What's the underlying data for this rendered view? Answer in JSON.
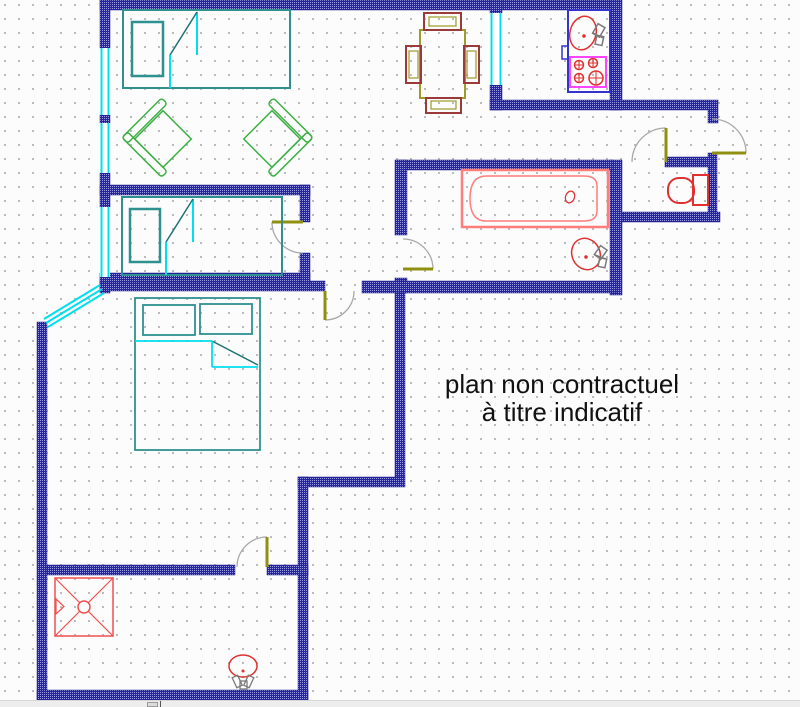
{
  "annotation": {
    "line1": "plan non contractuel",
    "line2": "à titre indicatif",
    "x_center": 562,
    "y_top": 370,
    "font_size": 26,
    "color": "#111111"
  },
  "canvas": {
    "width": 800,
    "height": 700,
    "bg": "#fcfcfc",
    "grid_dot_color": "#bcbcbc",
    "grid_step": 14
  },
  "strip": {
    "y": 700,
    "height": 7,
    "bg": "#ededed",
    "border": "#d6d6d6",
    "handle": {
      "x": 147,
      "y": 701,
      "w": 11,
      "h": 5,
      "fill": "#dcdcdc",
      "border": "#9a9a9a"
    },
    "caret": {
      "x": 160,
      "color": "#555555"
    }
  },
  "plan": {
    "wall_base": "#26269c",
    "wall_fleck": "#9b9be0",
    "wall_edge": "#1e1e8e",
    "window_color": "#00dfee",
    "door_leaf_color": "#8f8f12",
    "door_arc_color": "#a8a8a8",
    "walls": [
      [
        100,
        0,
        520,
        10
      ],
      [
        100,
        0,
        10,
        48
      ],
      [
        100,
        115,
        10,
        8
      ],
      [
        100,
        173,
        10,
        34
      ],
      [
        100,
        277,
        10,
        16
      ],
      [
        490,
        0,
        12,
        13
      ],
      [
        490,
        85,
        12,
        25
      ],
      [
        610,
        0,
        12,
        110
      ],
      [
        490,
        100,
        228,
        10
      ],
      [
        708,
        110,
        10,
        13
      ],
      [
        708,
        153,
        9,
        62
      ],
      [
        665,
        157,
        47,
        10
      ],
      [
        615,
        212,
        105,
        10
      ],
      [
        610,
        160,
        12,
        135
      ],
      [
        398,
        160,
        215,
        10
      ],
      [
        395,
        160,
        12,
        75
      ],
      [
        395,
        278,
        12,
        15
      ],
      [
        362,
        281,
        255,
        12
      ],
      [
        100,
        281,
        225,
        10
      ],
      [
        100,
        273,
        210,
        10
      ],
      [
        100,
        185,
        210,
        10
      ],
      [
        300,
        185,
        10,
        37
      ],
      [
        300,
        253,
        10,
        30
      ],
      [
        395,
        293,
        10,
        184
      ],
      [
        298,
        477,
        107,
        10
      ],
      [
        298,
        477,
        10,
        223
      ],
      [
        37,
        322,
        10,
        378
      ],
      [
        37,
        690,
        271,
        10
      ],
      [
        47,
        565,
        188,
        10
      ],
      [
        267,
        565,
        41,
        10
      ]
    ],
    "windows": [
      {
        "x": 100,
        "y": 48,
        "w": 10,
        "h": 67
      },
      {
        "x": 100,
        "y": 123,
        "w": 10,
        "h": 50
      },
      {
        "x": 100,
        "y": 207,
        "w": 10,
        "h": 70
      },
      {
        "x": 490,
        "y": 13,
        "w": 12,
        "h": 72
      }
    ],
    "diagonal_window": [
      [
        100,
        285,
        44,
        319
      ],
      [
        102,
        289,
        46,
        323
      ],
      [
        104,
        293,
        48,
        327
      ]
    ],
    "doors": [
      {
        "name": "entrance-door",
        "leaf": [
          712,
          153,
          746,
          153
        ],
        "arc": "M 746,153 A 34 34 0 0 0 712,119"
      },
      {
        "name": "wc-door",
        "leaf": [
          666,
          128,
          666,
          162
        ],
        "arc": "M 666,128 A 34 34 0 0 0 632,162"
      },
      {
        "name": "bathroom-door",
        "leaf": [
          403,
          269,
          433,
          269
        ],
        "arc": "M 433,269 A 30 30 0 0 0 403,239"
      },
      {
        "name": "middle-bedroom-door",
        "leaf": [
          303,
          222,
          272,
          222
        ],
        "arc": "M 272,222 A 31 31 0 0 0 303,253"
      },
      {
        "name": "master-bedroom-door",
        "leaf": [
          325,
          291,
          325,
          320
        ],
        "arc": "M 325,320 A 29 29 0 0 0 354,291"
      },
      {
        "name": "shower-room-door",
        "leaf": [
          267,
          537,
          267,
          567
        ],
        "arc": "M 267,537 A 30 30 0 0 0 237,567"
      }
    ],
    "objects": [
      {
        "name": "single-bed-top",
        "items": [
          {
            "t": "rect",
            "x": 123,
            "y": 10,
            "w": 167,
            "h": 78,
            "st": "#2f9090",
            "sw": 2
          },
          {
            "t": "rect",
            "x": 132,
            "y": 22,
            "w": 31,
            "h": 54,
            "st": "#2f9090",
            "sw": 2.5
          },
          {
            "t": "line",
            "x1": 197,
            "y1": 12,
            "x2": 197,
            "y2": 55,
            "st": "#00dfee",
            "sw": 2
          },
          {
            "t": "line",
            "x1": 197,
            "y1": 12,
            "x2": 170,
            "y2": 55,
            "st": "#1d7272",
            "sw": 1.5
          },
          {
            "t": "line",
            "x1": 170,
            "y1": 55,
            "x2": 170,
            "y2": 88,
            "st": "#00dfee",
            "sw": 2
          }
        ]
      },
      {
        "name": "single-bed-middle",
        "items": [
          {
            "t": "rect",
            "x": 122,
            "y": 197,
            "w": 160,
            "h": 78,
            "st": "#2f9090",
            "sw": 2
          },
          {
            "t": "rect",
            "x": 130,
            "y": 209,
            "w": 30,
            "h": 53,
            "st": "#2f9090",
            "sw": 2.5
          },
          {
            "t": "line",
            "x1": 193,
            "y1": 199,
            "x2": 193,
            "y2": 242,
            "st": "#00dfee",
            "sw": 2
          },
          {
            "t": "line",
            "x1": 193,
            "y1": 199,
            "x2": 166,
            "y2": 242,
            "st": "#1d7272",
            "sw": 1.5
          },
          {
            "t": "line",
            "x1": 166,
            "y1": 242,
            "x2": 166,
            "y2": 275,
            "st": "#00dfee",
            "sw": 2
          }
        ]
      },
      {
        "name": "armchair-left",
        "items": [
          {
            "t": "rect",
            "x": 143,
            "y": 119,
            "w": 40,
            "h": 40,
            "st": "#3cb044",
            "sw": 1.5,
            "tr": "rotate(45 163 139)"
          },
          {
            "t": "rect",
            "x": 133,
            "y": 111,
            "w": 8,
            "h": 56,
            "rx": 3,
            "st": "#3cb044",
            "sw": 1.5,
            "tr": "rotate(45 163 139)"
          },
          {
            "t": "rect",
            "x": 133,
            "y": 159,
            "w": 56,
            "h": 8,
            "rx": 3,
            "st": "#3cb044",
            "sw": 1.5,
            "tr": "rotate(45 163 139)"
          }
        ]
      },
      {
        "name": "armchair-right",
        "items": [
          {
            "t": "rect",
            "x": 252,
            "y": 119,
            "w": 40,
            "h": 40,
            "st": "#3cb044",
            "sw": 1.5,
            "tr": "rotate(-45 272 139)"
          },
          {
            "t": "rect",
            "x": 294,
            "y": 111,
            "w": 8,
            "h": 56,
            "rx": 3,
            "st": "#3cb044",
            "sw": 1.5,
            "tr": "rotate(-45 272 139)"
          },
          {
            "t": "rect",
            "x": 246,
            "y": 159,
            "w": 56,
            "h": 8,
            "rx": 3,
            "st": "#3cb044",
            "sw": 1.5,
            "tr": "rotate(-45 272 139)"
          }
        ]
      },
      {
        "name": "dining-table",
        "items": [
          {
            "t": "rect",
            "x": 420,
            "y": 30,
            "w": 45,
            "h": 68,
            "st": "#9c9c2a",
            "sw": 2
          },
          {
            "t": "rect",
            "x": 424,
            "y": 13,
            "w": 37,
            "h": 17,
            "st": "#9c3a3a",
            "sw": 2
          },
          {
            "t": "rect",
            "x": 429,
            "y": 17,
            "w": 27,
            "h": 9,
            "st": "#9c9c2a",
            "sw": 1.2
          },
          {
            "t": "rect",
            "x": 426,
            "y": 98,
            "w": 35,
            "h": 15,
            "st": "#9c3a3a",
            "sw": 2
          },
          {
            "t": "rect",
            "x": 431,
            "y": 101,
            "w": 25,
            "h": 8,
            "st": "#9c9c2a",
            "sw": 1.2
          },
          {
            "t": "rect",
            "x": 406,
            "y": 46,
            "w": 15,
            "h": 37,
            "st": "#9c3a3a",
            "sw": 2
          },
          {
            "t": "rect",
            "x": 409,
            "y": 51,
            "w": 9,
            "h": 27,
            "st": "#9c9c2a",
            "sw": 1.2
          },
          {
            "t": "rect",
            "x": 464,
            "y": 46,
            "w": 15,
            "h": 37,
            "st": "#9c3a3a",
            "sw": 2
          },
          {
            "t": "rect",
            "x": 467,
            "y": 51,
            "w": 9,
            "h": 27,
            "st": "#9c9c2a",
            "sw": 1.2
          }
        ]
      },
      {
        "name": "kitchen-counter",
        "items": [
          {
            "t": "rect",
            "x": 568,
            "y": 10,
            "w": 42,
            "h": 82,
            "st": "#3434cc",
            "sw": 2
          },
          {
            "t": "rect",
            "x": 562,
            "y": 46,
            "w": 6,
            "h": 13,
            "st": "#3434cc",
            "sw": 1.5
          }
        ]
      },
      {
        "name": "kitchen-sink",
        "items": [
          {
            "t": "ellipse",
            "cx": 583,
            "cy": 33,
            "rx": 13,
            "ry": 17,
            "st": "#e03030",
            "sw": 1.5,
            "tr": "rotate(15 583 33)"
          },
          {
            "t": "circle",
            "cx": 584,
            "cy": 36,
            "r": 1.8,
            "f": "#e03030"
          },
          {
            "t": "rect",
            "x": 595,
            "y": 25,
            "w": 8,
            "h": 11,
            "st": "#7a7a7a",
            "sw": 1.5,
            "tr": "rotate(30 599 30)"
          },
          {
            "t": "rect",
            "x": 596,
            "y": 36,
            "w": 7,
            "h": 9,
            "st": "#7a7a7a",
            "sw": 1.5,
            "tr": "rotate(12 600 40)"
          },
          {
            "t": "line",
            "x1": 593,
            "y1": 33,
            "x2": 603,
            "y2": 38,
            "st": "#7a7a7a",
            "sw": 1.5
          }
        ]
      },
      {
        "name": "stove",
        "items": [
          {
            "t": "rect",
            "x": 570,
            "y": 57,
            "w": 36,
            "h": 30,
            "st": "#ff44ff",
            "sw": 2
          },
          {
            "t": "circle",
            "cx": 579,
            "cy": 65,
            "r": 4.5,
            "st": "#e03030",
            "sw": 1.5
          },
          {
            "t": "line",
            "x1": 575,
            "y1": 65,
            "x2": 583,
            "y2": 65,
            "st": "#e03030",
            "sw": 1
          },
          {
            "t": "line",
            "x1": 579,
            "y1": 61,
            "x2": 579,
            "y2": 69,
            "st": "#e03030",
            "sw": 1
          },
          {
            "t": "circle",
            "cx": 593,
            "cy": 63,
            "r": 4.5,
            "st": "#e03030",
            "sw": 1.5
          },
          {
            "t": "line",
            "x1": 589,
            "y1": 63,
            "x2": 597,
            "y2": 63,
            "st": "#e03030",
            "sw": 1
          },
          {
            "t": "line",
            "x1": 593,
            "y1": 59,
            "x2": 593,
            "y2": 67,
            "st": "#e03030",
            "sw": 1
          },
          {
            "t": "circle",
            "cx": 579,
            "cy": 78,
            "r": 4.5,
            "st": "#e03030",
            "sw": 1.5
          },
          {
            "t": "line",
            "x1": 575,
            "y1": 78,
            "x2": 583,
            "y2": 78,
            "st": "#e03030",
            "sw": 1
          },
          {
            "t": "line",
            "x1": 579,
            "y1": 74,
            "x2": 579,
            "y2": 82,
            "st": "#e03030",
            "sw": 1
          },
          {
            "t": "circle",
            "cx": 596,
            "cy": 78,
            "r": 7,
            "st": "#e03030",
            "sw": 1.5
          },
          {
            "t": "line",
            "x1": 589,
            "y1": 78,
            "x2": 603,
            "y2": 78,
            "st": "#e03030",
            "sw": 1
          },
          {
            "t": "line",
            "x1": 596,
            "y1": 71,
            "x2": 596,
            "y2": 85,
            "st": "#e03030",
            "sw": 1
          }
        ]
      },
      {
        "name": "bathtub",
        "items": [
          {
            "t": "rect",
            "x": 462,
            "y": 170,
            "w": 146,
            "h": 57,
            "st": "#ff7d7d",
            "sw": 2.5
          },
          {
            "t": "path",
            "d": "M 486,176 H 584 Q 597,176 597,186 V 211 Q 597,221 584,221 H 486 Q 470,221 470,198.5 Q 470,176 486,176 Z",
            "st": "#ff7d7d",
            "sw": 1.5
          },
          {
            "t": "ellipse",
            "cx": 570,
            "cy": 197,
            "rx": 4.5,
            "ry": 6,
            "st": "#e03030",
            "sw": 1.3,
            "tr": "rotate(20 570 197)"
          }
        ]
      },
      {
        "name": "bathroom-washbasin",
        "items": [
          {
            "t": "ellipse",
            "cx": 586,
            "cy": 254,
            "rx": 14,
            "ry": 16,
            "st": "#e03030",
            "sw": 1.5,
            "tr": "rotate(-25 586 254)"
          },
          {
            "t": "circle",
            "cx": 586,
            "cy": 257,
            "r": 1.8,
            "f": "#e03030"
          },
          {
            "t": "rect",
            "x": 597,
            "y": 247,
            "w": 8,
            "h": 11,
            "st": "#7a7a7a",
            "sw": 1.5,
            "tr": "rotate(35 601 252)"
          },
          {
            "t": "rect",
            "x": 599,
            "y": 258,
            "w": 7,
            "h": 9,
            "st": "#7a7a7a",
            "sw": 1.5,
            "tr": "rotate(12 602 262)"
          },
          {
            "t": "line",
            "x1": 595,
            "y1": 255,
            "x2": 605,
            "y2": 259,
            "st": "#7a7a7a",
            "sw": 1.5
          }
        ]
      },
      {
        "name": "toilet",
        "items": [
          {
            "t": "rect",
            "x": 668,
            "y": 178,
            "w": 26,
            "h": 25,
            "rx": 11,
            "st": "#e03030",
            "sw": 2
          },
          {
            "t": "rect",
            "x": 693,
            "y": 175,
            "w": 15,
            "h": 30,
            "st": "#e03030",
            "sw": 2
          },
          {
            "t": "line",
            "x1": 693,
            "y1": 183,
            "x2": 693,
            "y2": 197,
            "st": "#e03030",
            "sw": 1.2
          }
        ]
      },
      {
        "name": "shower",
        "items": [
          {
            "t": "rect",
            "x": 55,
            "y": 578,
            "w": 58,
            "h": 58,
            "st": "#f05050",
            "sw": 1.5
          },
          {
            "t": "line",
            "x1": 55,
            "y1": 578,
            "x2": 113,
            "y2": 636,
            "st": "#f05050",
            "sw": 1.2
          },
          {
            "t": "line",
            "x1": 113,
            "y1": 578,
            "x2": 55,
            "y2": 636,
            "st": "#f05050",
            "sw": 1.2
          },
          {
            "t": "circle",
            "cx": 84,
            "cy": 607,
            "r": 6,
            "st": "#f05050",
            "sw": 1.5,
            "f": "#ffffff"
          },
          {
            "t": "path",
            "d": "M 56,599 L 64,606.5 L 56,614 Z",
            "st": "#f05050",
            "sw": 1.2
          }
        ]
      },
      {
        "name": "shower-room-washbasin",
        "items": [
          {
            "t": "ellipse",
            "cx": 243,
            "cy": 666,
            "rx": 14,
            "ry": 11,
            "st": "#e03030",
            "sw": 1.5
          },
          {
            "t": "circle",
            "cx": 243,
            "cy": 671,
            "r": 1.5,
            "f": "#e03030"
          },
          {
            "t": "rect",
            "x": 234,
            "y": 676,
            "w": 6,
            "h": 11,
            "st": "#7a7a7a",
            "sw": 1.3,
            "tr": "rotate(-25 237 681)"
          },
          {
            "t": "rect",
            "x": 246,
            "y": 676,
            "w": 6,
            "h": 11,
            "st": "#7a7a7a",
            "sw": 1.3,
            "tr": "rotate(25 249 681)"
          },
          {
            "t": "rect",
            "x": 240,
            "y": 681,
            "w": 7,
            "h": 8,
            "st": "#7a7a7a",
            "sw": 1.3
          }
        ]
      },
      {
        "name": "double-bed",
        "items": [
          {
            "t": "rect",
            "x": 135,
            "y": 298,
            "w": 125,
            "h": 152,
            "st": "#2f9090",
            "sw": 1.8
          },
          {
            "t": "rect",
            "x": 143,
            "y": 305,
            "w": 52,
            "h": 30,
            "st": "#2f9090",
            "sw": 1.8
          },
          {
            "t": "rect",
            "x": 200,
            "y": 304,
            "w": 52,
            "h": 30,
            "st": "#2f9090",
            "sw": 1.8
          },
          {
            "t": "line",
            "x1": 135,
            "y1": 341,
            "x2": 212,
            "y2": 341,
            "st": "#00dfee",
            "sw": 1.8
          },
          {
            "t": "line",
            "x1": 212,
            "y1": 341,
            "x2": 258,
            "y2": 365,
            "st": "#1d7272",
            "sw": 1.5
          },
          {
            "t": "line",
            "x1": 212,
            "y1": 341,
            "x2": 212,
            "y2": 367,
            "st": "#00dfee",
            "sw": 1.8
          },
          {
            "t": "line",
            "x1": 212,
            "y1": 367,
            "x2": 258,
            "y2": 367,
            "st": "#00dfee",
            "sw": 1.8
          }
        ]
      }
    ]
  }
}
